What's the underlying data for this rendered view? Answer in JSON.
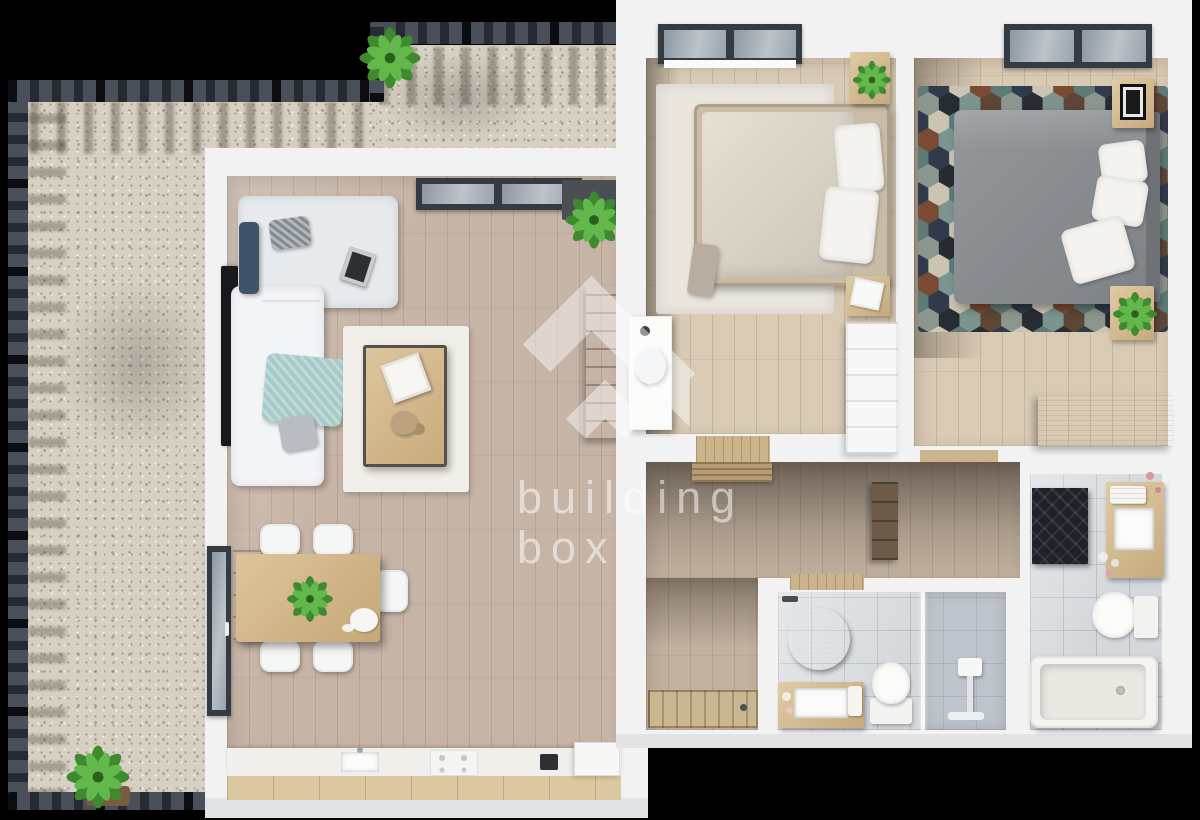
{
  "watermark": {
    "line1": "building",
    "line2": "box",
    "color": "#ffffff",
    "opacity": 0.48
  },
  "palette": {
    "background": "#000000",
    "walls": "#f2f2f3",
    "wall_face": "#e2e3e5",
    "terrace_gravel": "#d6d0c3",
    "fence": "#343a41",
    "living_floor": "#c6b4a6",
    "bedroom_floor": "#d8cab5",
    "hall_floor": "#c2b1a0",
    "bathroom_tile": "#d4d8dc",
    "furniture_wood": "#d3b98c",
    "kitchen_wood": "#dbc7a0",
    "sofa_white": "#f3f4f6",
    "sofa_chaise": "#e7eaec",
    "accent_navy": "#41536b",
    "accent_teal": "#a6cac8",
    "bed2_duvet": "#87898d",
    "rug_dark": "#46392e",
    "plant_green": "#4f9e3d"
  },
  "scene": {
    "type": "apartment-floor-plan-3d-top-view",
    "rooms": [
      {
        "name": "terrace",
        "items": [
          "metal railing",
          "gravel floor",
          "potted plant",
          "potted plant"
        ]
      },
      {
        "name": "living-room-kitchen",
        "items": [
          "corner sofa",
          "navy cushion",
          "teal throw blanket",
          "white rug",
          "coffee table",
          "tv",
          "wall shelf",
          "console plant",
          "window",
          "balcony door",
          "dining table",
          "5 dining chairs",
          "table plant",
          "kitchen counter",
          "sink",
          "cooktop",
          "fridge"
        ]
      },
      {
        "name": "bedroom-1",
        "items": [
          "double bed",
          "area rug",
          "nightstand with plant",
          "nightstand with papers",
          "desk",
          "desk chair",
          "wardrobe",
          "window"
        ]
      },
      {
        "name": "bedroom-2",
        "items": [
          "double bed",
          "hexagon mosaic rug",
          "nightstand with picture",
          "plant stand",
          "dresser",
          "window"
        ]
      },
      {
        "name": "hallway",
        "items": [
          "doormat",
          "coat rack",
          "entrance door"
        ]
      },
      {
        "name": "bathroom-1",
        "items": [
          "round rug",
          "wood vanity with sink",
          "toilet",
          "walk-in shower"
        ]
      },
      {
        "name": "bathroom-2",
        "items": [
          "dark patterned rug",
          "wood vanity with sink",
          "towels",
          "toilet",
          "bathtub"
        ]
      }
    ]
  }
}
